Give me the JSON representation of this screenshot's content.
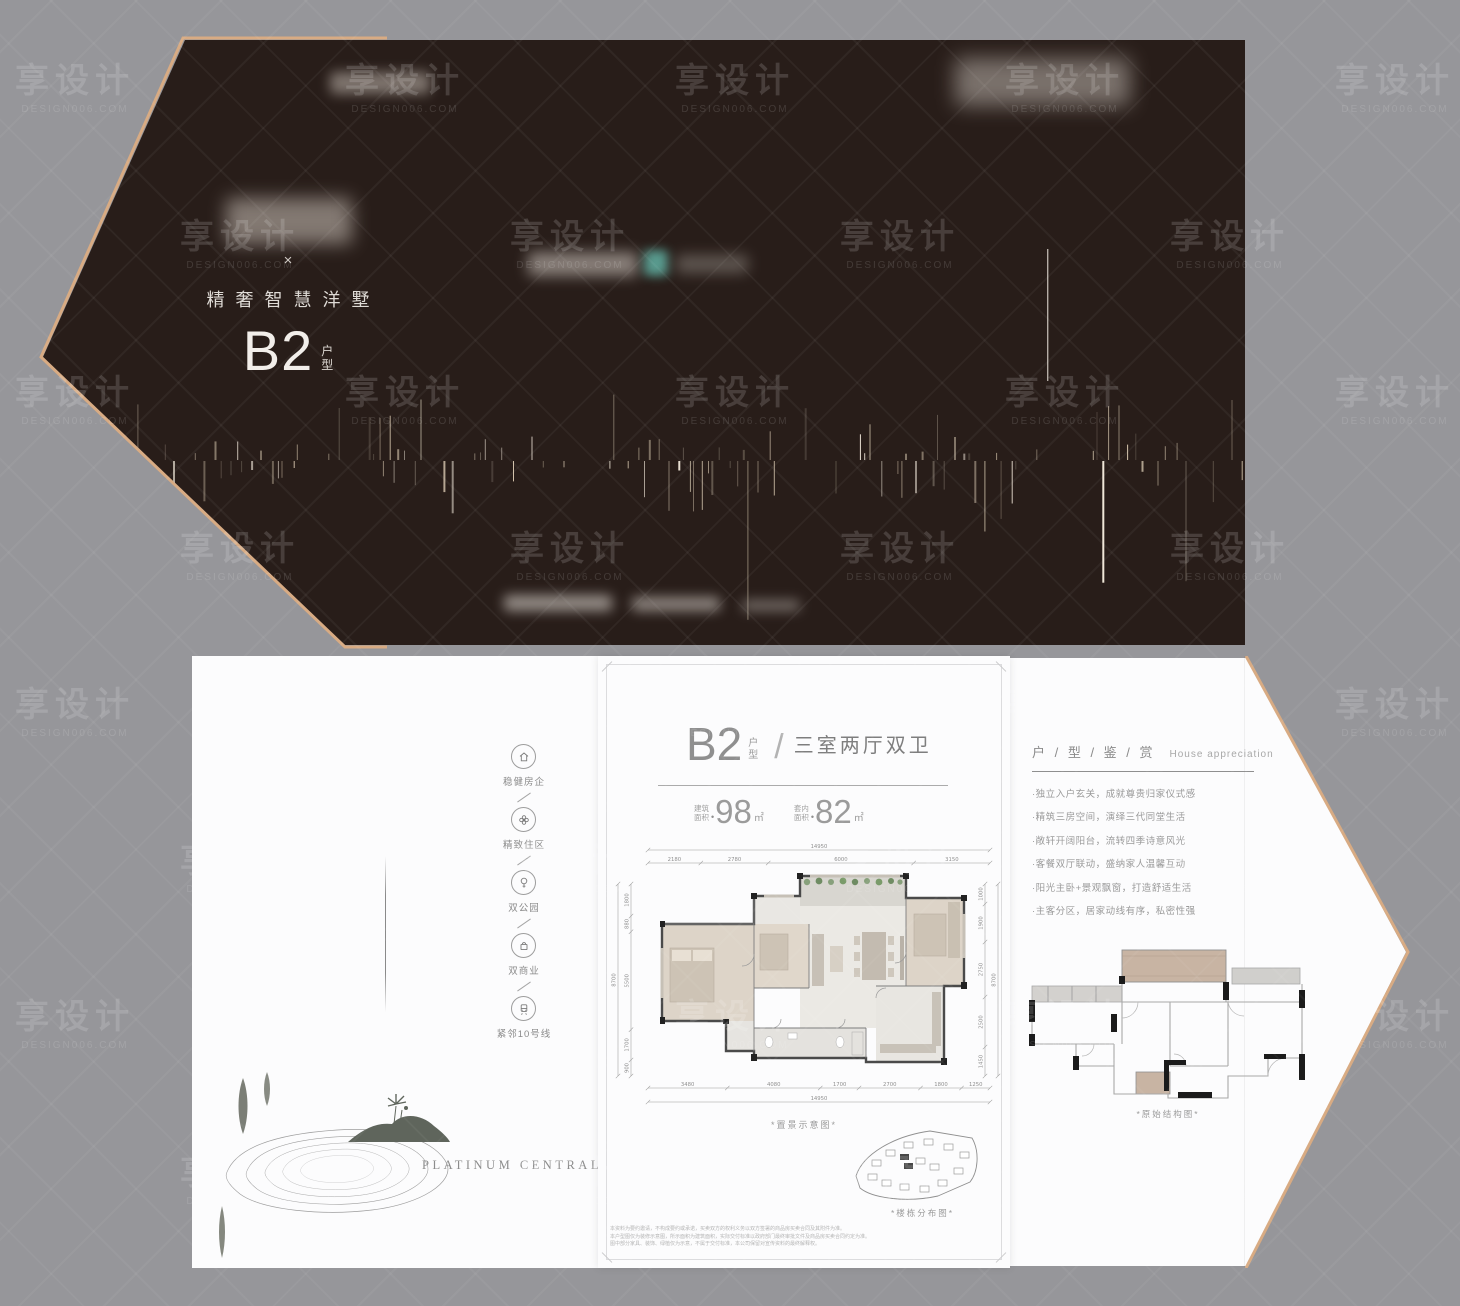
{
  "colors": {
    "gold": "#d8ab83",
    "panel_dark": "#281d19",
    "teal": "#5ea89b",
    "bg": "#96969a"
  },
  "watermark": {
    "text": "享设计",
    "sub": "DESIGN006.COM"
  },
  "top_panel": {
    "times": "×",
    "tagline": "精奢智慧洋墅",
    "unit": "B2",
    "unit_char1": "户",
    "unit_char2": "型"
  },
  "sidebar": {
    "items": [
      {
        "icon": "house",
        "label": "稳健房企"
      },
      {
        "icon": "flower",
        "label": "精致住区"
      },
      {
        "icon": "tree",
        "label": "双公园"
      },
      {
        "icon": "shop",
        "label": "双商业"
      },
      {
        "icon": "train",
        "label": "紧邻10号线"
      }
    ]
  },
  "brand": {
    "name": "PLATINUM CENTRAL"
  },
  "unit_page": {
    "unit": "B2",
    "unit_char1": "户",
    "unit_char2": "型",
    "slash": "/",
    "layout": "三室两厅双卫",
    "area_dot": "•",
    "area1": {
      "l1": "建筑",
      "l2": "面积",
      "v": "98",
      "u": "㎡"
    },
    "area2": {
      "l1": "套内",
      "l2": "面积",
      "v": "82",
      "u": "㎡"
    },
    "dims": {
      "top_total": "14950",
      "top": [
        "2180",
        "2780",
        "6000",
        "3150"
      ],
      "bottom": [
        "3480",
        "4080",
        "1700",
        "2700",
        "1800",
        "1250"
      ],
      "bottom_total": "14950",
      "left": [
        "1800",
        "880",
        "5500",
        "1700",
        "900"
      ],
      "left_total": "8700",
      "right": [
        "1000",
        "1900",
        "2750",
        "2500",
        "1450"
      ],
      "right_total": "8700"
    },
    "plan_caption": "*置景示意图*",
    "site_caption": "*楼栋分布图*",
    "disclaimer": [
      "本资料为要约邀请，不构成要约或承诺，买卖双方的权利义务以双方签署的商品房买卖合同及其附件为准。",
      "本户型图仅为装修示意图，所示面积为建筑面积，实际交付标准以政府部门最终审批文件及商品房买卖合同约定为准。",
      "图中部分家具、装饰、绿植仅为示意，不属于交付标准，本公司保留对宣传资料的最终解释权。"
    ]
  },
  "appreciation": {
    "title": "户 / 型 / 鉴 / 赏",
    "subtitle": "House appreciation",
    "bullets": [
      "·独立入户玄关，成就尊贵归家仪式感",
      "·精筑三房空间，演绎三代同堂生活",
      "·敞轩开阔阳台，流转四季诗意风光",
      "·客餐双厅联动，盛纳家人温馨互动",
      "·阳光主卧+景观飘窗，打造舒适生活",
      "·主客分区，居家动线有序，私密性强"
    ],
    "plan_caption": "*原始结构图*"
  }
}
